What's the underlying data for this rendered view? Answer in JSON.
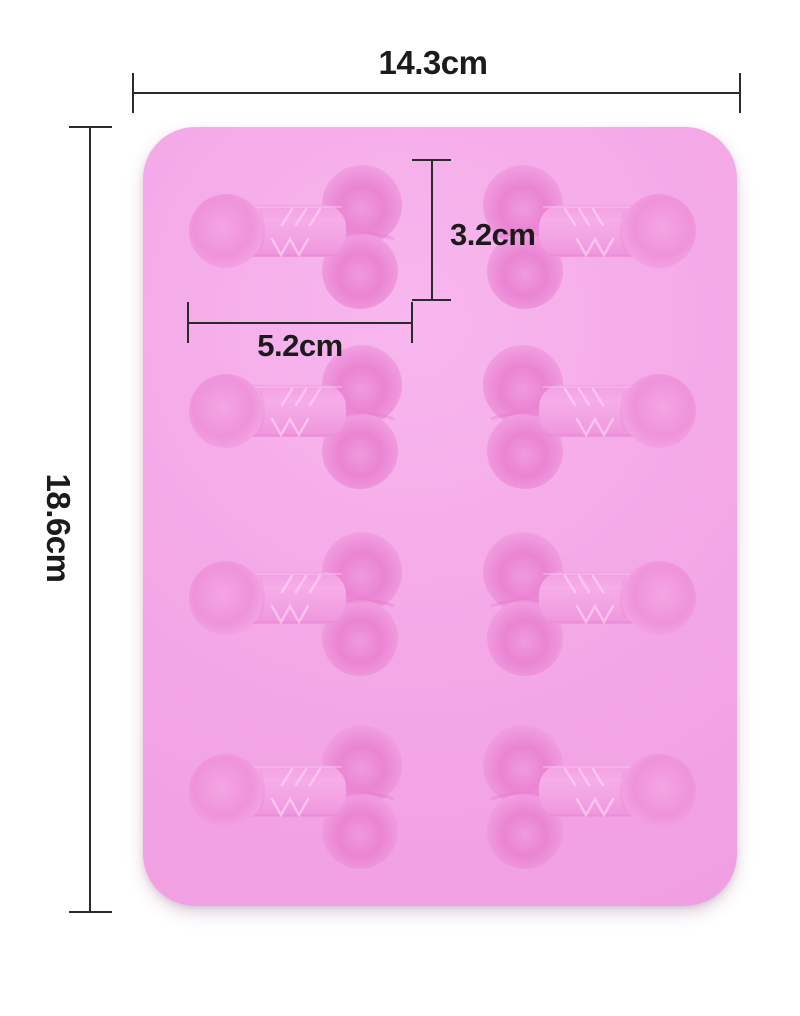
{
  "page": {
    "background": "#ffffff"
  },
  "diagram": {
    "kind": "product-dimension-diagram",
    "product": "pink silicone novelty mold tray",
    "line_color": "#2b2b2b",
    "mold": {
      "color": "#f4a9e7",
      "cavity_color": "#ee8fd9",
      "rows": 4,
      "columns": 2,
      "cavity_count": 8
    },
    "dimensions": {
      "overall_width": "14.3cm",
      "overall_height": "18.6cm",
      "cavity_height": "3.2cm",
      "cavity_length": "5.2cm"
    }
  }
}
